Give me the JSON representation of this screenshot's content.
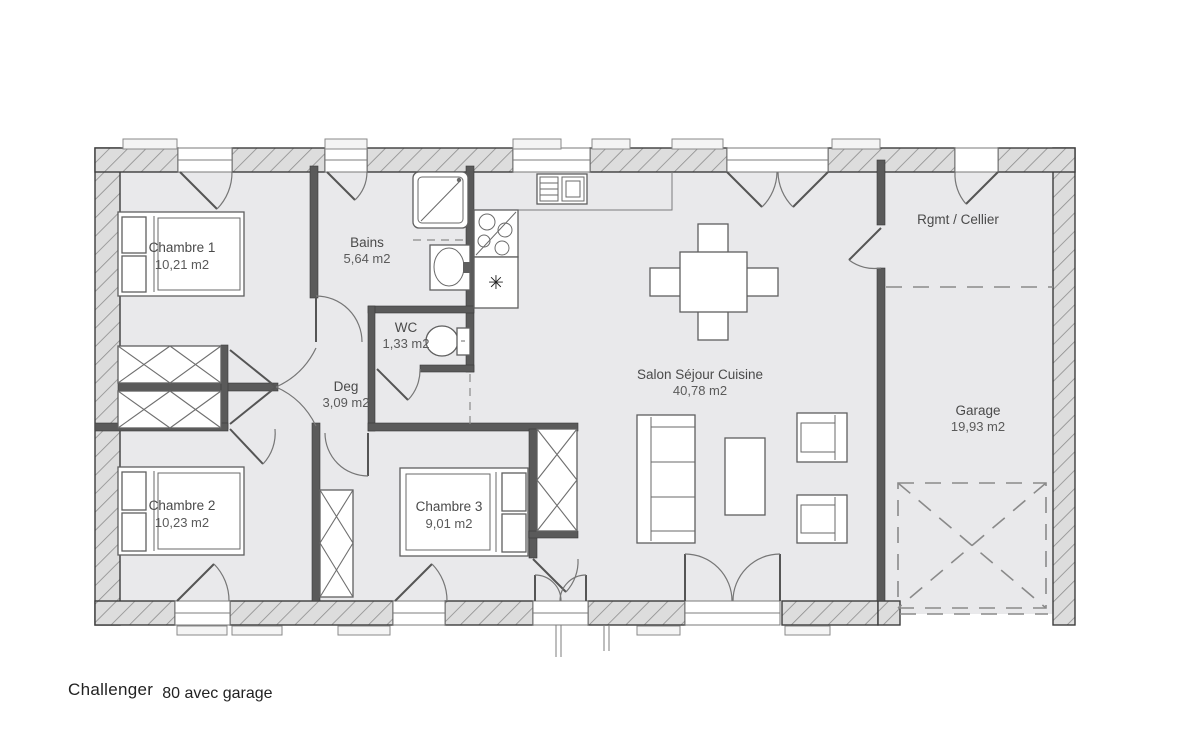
{
  "plan": {
    "caption": {
      "brand": "Challenger",
      "model": "80 avec garage"
    },
    "rooms": {
      "chambre1": {
        "name": "Chambre 1",
        "area": "10,21 m2"
      },
      "bains": {
        "name": "Bains",
        "area": "5,64 m2"
      },
      "wc": {
        "name": "WC",
        "area": "1,33 m2"
      },
      "deg": {
        "name": "Deg",
        "area": "3,09 m2"
      },
      "chambre2": {
        "name": "Chambre 2",
        "area": "10,23 m2"
      },
      "chambre3": {
        "name": "Chambre 3",
        "area": "9,01 m2"
      },
      "salon": {
        "name": "Salon Séjour Cuisine",
        "area": "40,78 m2"
      },
      "cellier": {
        "name": "Rgmt / Cellier"
      },
      "garage": {
        "name": "Garage",
        "area": "19,93 m2"
      }
    },
    "symbols": {
      "fridge_asterisk": "✳"
    },
    "colors": {
      "wall": "#3d3d3d",
      "interior_wall": "#5a5a5a",
      "floor": "#e9e9eb",
      "text": "#4a4a4a"
    }
  }
}
